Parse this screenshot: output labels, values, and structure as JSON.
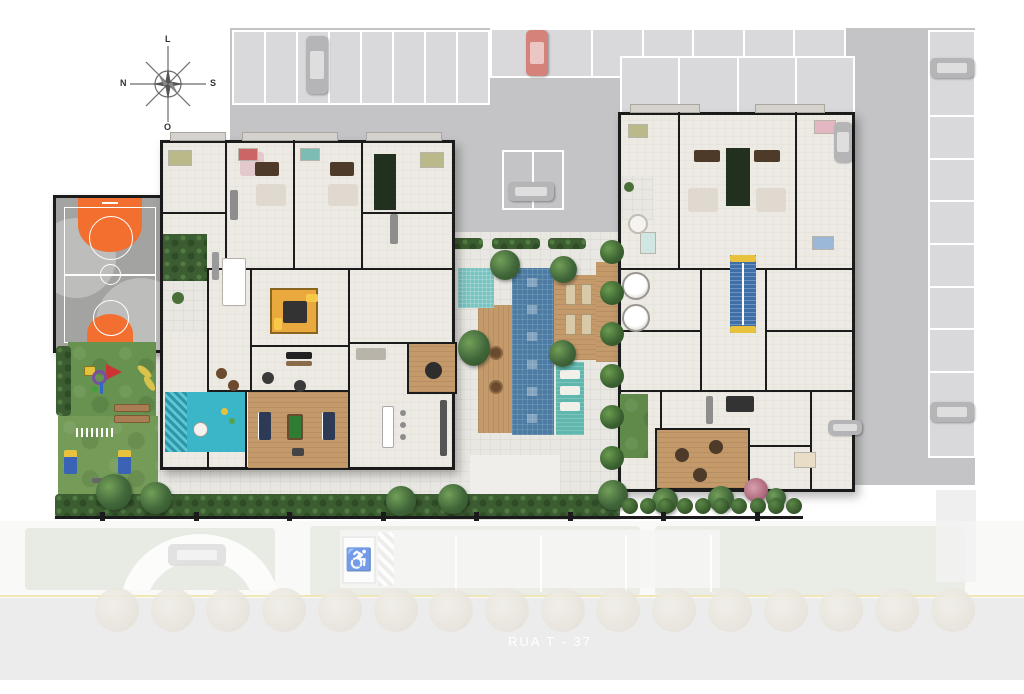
{
  "scene": {
    "type": "architectural-site-plan",
    "description": "residential condominium ground floor / leisure site plan"
  },
  "street": {
    "label": "RUA T - 37"
  },
  "compass": {
    "top": "L",
    "right": "S",
    "bottom": "O",
    "left": "N"
  },
  "icons": {
    "accessible_parking": "♿",
    "compass_rose": "compass-rose"
  },
  "colors": {
    "parking_asphalt": "#c4c4c6",
    "parking_stall": "#d9d9db",
    "building_floor": "#edeae4",
    "wall": "#1b1b1b",
    "lap_pool": "#4c7ca3",
    "kids_pool": "#79c4c0",
    "wet_deck": "#5fb7ad",
    "wood_deck": "#c49a6b",
    "lawn": "#749b58",
    "hedge": "#3c5c31",
    "court_surface": "#a3a3a1",
    "court_key_orange": "#f26f2f",
    "street_surface": "#e4e4e4",
    "lane_line_yellow": "#e6d77f",
    "play_structure_yellow": "#e9a93f",
    "game_table_green": "#2e7d32"
  },
  "counts": {
    "stalls_row_a": 8,
    "stalls_row_b": 7,
    "stalls_row_c": 4,
    "stalls_right_column": 10,
    "street_trees": 16,
    "hedge_bushes": 10,
    "palm_row_trees": 6,
    "fence_posts": 8,
    "pool_mosaic_tiles": 6
  }
}
